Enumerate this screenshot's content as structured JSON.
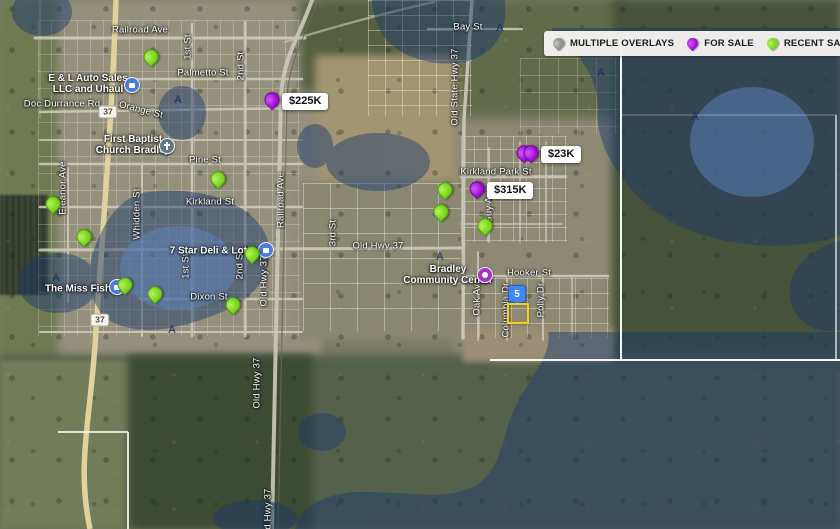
{
  "legend": {
    "items": [
      {
        "id": "multiple-overlays",
        "label": "MULTIPLE OVERLAYS",
        "color": "#8b8b8b",
        "color_light": "#c2c2c2"
      },
      {
        "id": "for-sale",
        "label": "FOR SALE",
        "color": "#a009d8",
        "color_light": "#cf5df2"
      },
      {
        "id": "recent-sale",
        "label": "RECENT SALE",
        "color": "#76d417",
        "color_light": "#b4f163"
      },
      {
        "id": "default",
        "label": "DEFAULT",
        "color": "#d4392a",
        "color_light": "#ef7a5e"
      }
    ]
  },
  "markers": {
    "price_labels": [
      {
        "text": "$225K",
        "x": 272,
        "y": 110,
        "pins": 1
      },
      {
        "text": "$23K",
        "x": 524,
        "y": 163,
        "pins": 2
      },
      {
        "text": "$315K",
        "x": 477,
        "y": 199,
        "pins": 1
      }
    ],
    "recent_sale_pins": [
      {
        "x": 151,
        "y": 67
      },
      {
        "x": 218,
        "y": 189
      },
      {
        "x": 53,
        "y": 214
      },
      {
        "x": 84,
        "y": 247
      },
      {
        "x": 252,
        "y": 264
      },
      {
        "x": 233,
        "y": 315
      },
      {
        "x": 125,
        "y": 295
      },
      {
        "x": 155,
        "y": 304
      },
      {
        "x": 445,
        "y": 200
      },
      {
        "x": 441,
        "y": 222
      },
      {
        "x": 485,
        "y": 236
      }
    ],
    "cluster": {
      "text": "5",
      "x": 516,
      "y": 305
    },
    "selected_parcel": {
      "x": 507,
      "y": 303,
      "w": 18,
      "h": 17
    }
  },
  "street_labels": [
    {
      "text": "Railroad Ave",
      "x": 140,
      "y": 30,
      "dir": "h"
    },
    {
      "text": "Palmetto St",
      "x": 203,
      "y": 73,
      "dir": "h"
    },
    {
      "text": "1st St",
      "x": 188,
      "y": 47,
      "dir": "v"
    },
    {
      "text": "2nd St",
      "x": 241,
      "y": 66,
      "dir": "v"
    },
    {
      "text": "Orange St",
      "x": 141,
      "y": 110,
      "dir": "h",
      "rot": 14
    },
    {
      "text": "Doc Durrance Rd",
      "x": 62,
      "y": 104,
      "dir": "h"
    },
    {
      "text": "Pine St",
      "x": 205,
      "y": 160,
      "dir": "h"
    },
    {
      "text": "Kirkland St",
      "x": 210,
      "y": 202,
      "dir": "h"
    },
    {
      "text": "Eleanor Ave",
      "x": 63,
      "y": 188,
      "dir": "v"
    },
    {
      "text": "Whidden St",
      "x": 137,
      "y": 214,
      "dir": "v"
    },
    {
      "text": "1st St",
      "x": 186,
      "y": 266,
      "dir": "v"
    },
    {
      "text": "2nd St",
      "x": 240,
      "y": 265,
      "dir": "v"
    },
    {
      "text": "Old Hwy 37",
      "x": 264,
      "y": 281,
      "dir": "v"
    },
    {
      "text": "Railroad Ave",
      "x": 281,
      "y": 200,
      "dir": "v"
    },
    {
      "text": "3rd St",
      "x": 333,
      "y": 233,
      "dir": "v"
    },
    {
      "text": "Old Hwy 37",
      "x": 378,
      "y": 246,
      "dir": "h"
    },
    {
      "text": "Dixon St",
      "x": 209,
      "y": 297,
      "dir": "h"
    },
    {
      "text": "Old State Hwy 37",
      "x": 455,
      "y": 87,
      "dir": "v"
    },
    {
      "text": "Bay St",
      "x": 468,
      "y": 27,
      "dir": "h"
    },
    {
      "text": "Kirkland Park St",
      "x": 496,
      "y": 172,
      "dir": "h"
    },
    {
      "text": "Guy Ave",
      "x": 489,
      "y": 205,
      "dir": "v"
    },
    {
      "text": "Hooker St",
      "x": 529,
      "y": 273,
      "dir": "h"
    },
    {
      "text": "Oak Ave",
      "x": 477,
      "y": 297,
      "dir": "v"
    },
    {
      "text": "Columbia Dr",
      "x": 506,
      "y": 310,
      "dir": "v"
    },
    {
      "text": "Polly Dr",
      "x": 541,
      "y": 300,
      "dir": "v"
    },
    {
      "text": "Old Hwy 37",
      "x": 257,
      "y": 383,
      "dir": "v"
    },
    {
      "text": "Old Hwy 37",
      "x": 268,
      "y": 514,
      "dir": "v"
    }
  ],
  "poi_labels": [
    {
      "lines": [
        "E & L Auto Sales",
        "LLC and Uhaul"
      ],
      "tx": 88,
      "ty": 84,
      "icon": {
        "x": 132,
        "y": 85,
        "color": "#4a7cd9",
        "glyph": "square",
        "name": "business-icon"
      }
    },
    {
      "lines": [
        "First Baptist",
        "Church Bradley"
      ],
      "tx": 133,
      "ty": 145,
      "icon": {
        "x": 167,
        "y": 146,
        "color": "#5e7889",
        "glyph": "cross",
        "name": "church-icon"
      }
    },
    {
      "lines": [
        "7 Star Deli & Lotto"
      ],
      "tx": 213,
      "ty": 251,
      "icon": {
        "x": 266,
        "y": 250,
        "color": "#4a7cd9",
        "glyph": "square",
        "name": "business-icon"
      }
    },
    {
      "lines": [
        "The Miss Fish"
      ],
      "tx": 78,
      "ty": 289,
      "icon": {
        "x": 117,
        "y": 287,
        "color": "#4a7cd9",
        "glyph": "square",
        "name": "business-icon"
      }
    },
    {
      "lines": [
        "Bradley",
        "Community Center"
      ],
      "tx": 448,
      "ty": 275,
      "icon": {
        "x": 485,
        "y": 275,
        "color": "#a335c0",
        "glyph": "circle",
        "name": "community-center-icon"
      }
    }
  ],
  "flood_zone_labels": [
    {
      "text": "A",
      "x": 178,
      "y": 100
    },
    {
      "text": "A",
      "x": 500,
      "y": 28
    },
    {
      "text": "A",
      "x": 601,
      "y": 73
    },
    {
      "text": "A",
      "x": 695,
      "y": 117
    },
    {
      "text": "A",
      "x": 56,
      "y": 278
    },
    {
      "text": "A",
      "x": 440,
      "y": 257
    },
    {
      "text": "A",
      "x": 172,
      "y": 330
    }
  ],
  "highway_shields": [
    {
      "text": "37",
      "x": 108,
      "y": 112
    },
    {
      "text": "37",
      "x": 100,
      "y": 320
    }
  ]
}
